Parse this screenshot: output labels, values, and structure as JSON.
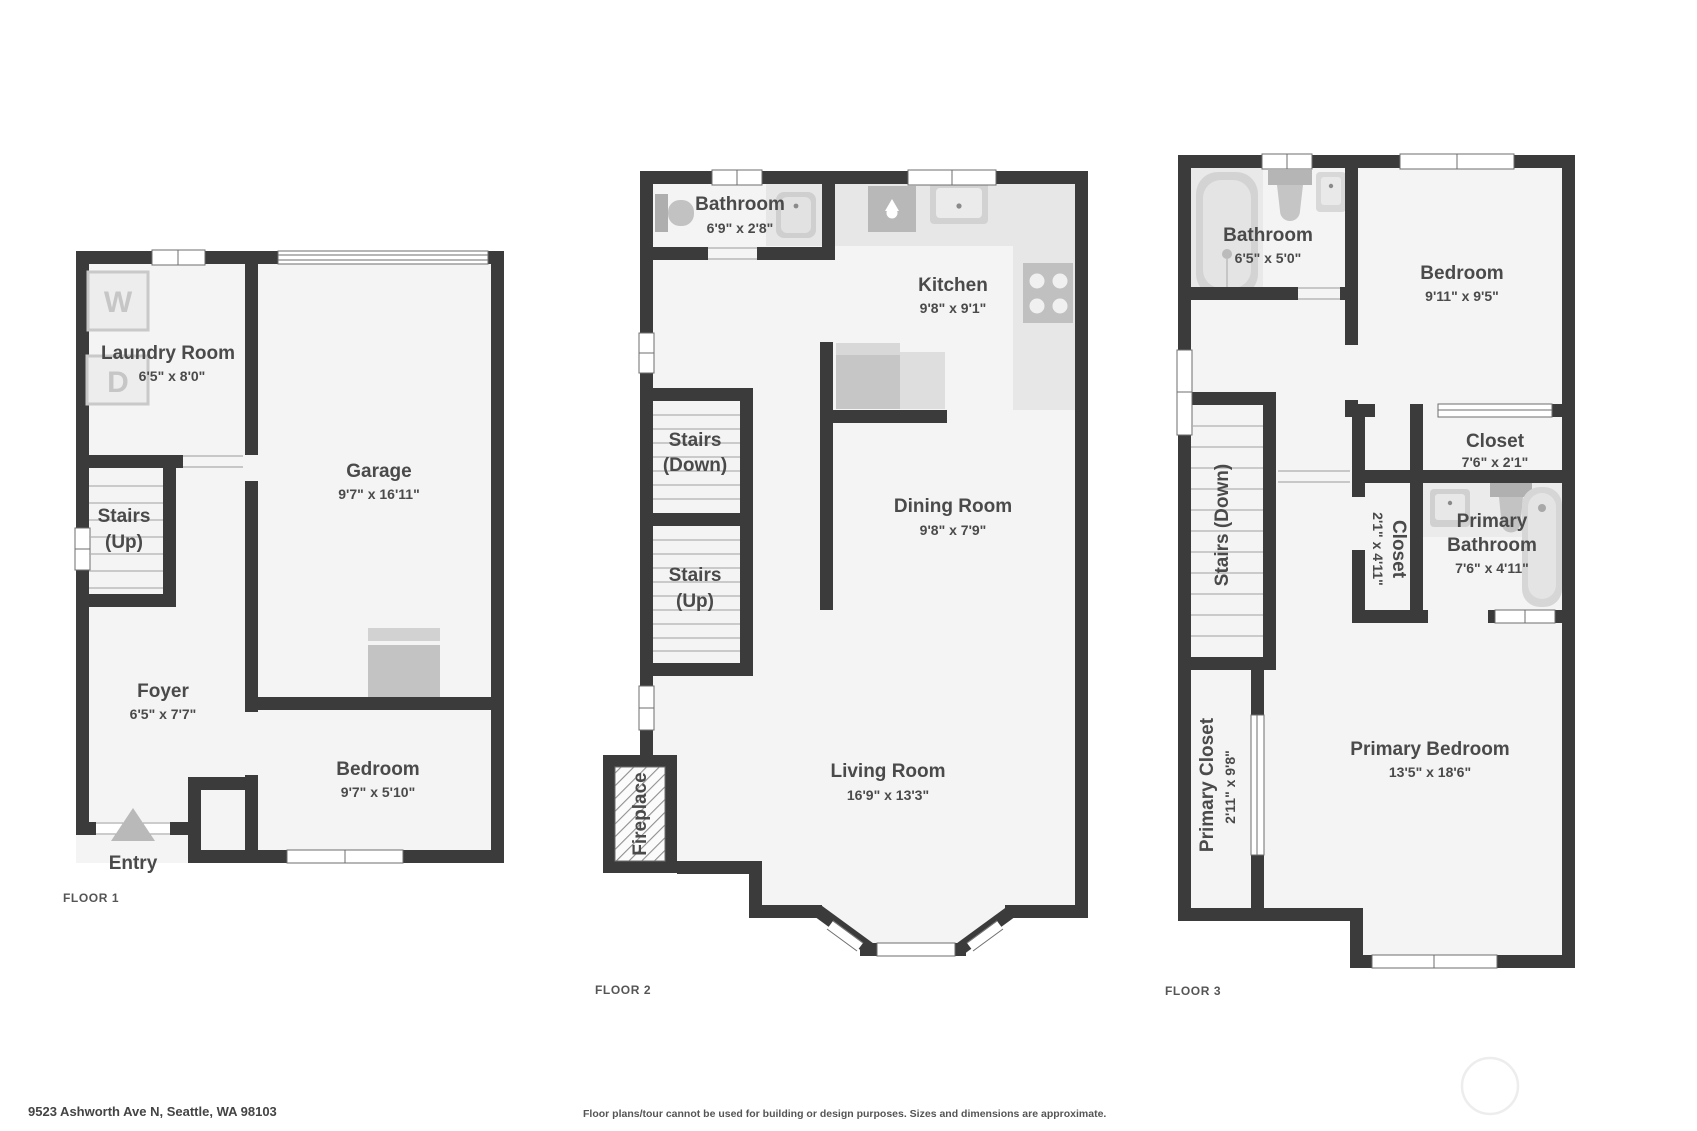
{
  "colors": {
    "wall": "#3b3b3b",
    "floor_fill": "#f4f4f4",
    "fixture": "#c9c9c9",
    "fixture_light": "#e6e6e6",
    "label_text": "#4a4a4a"
  },
  "floor1": {
    "label": "FLOOR 1",
    "laundry_name": "Laundry Room",
    "laundry_dims": "6'5\" x 8'0\"",
    "washer": "W",
    "dryer": "D",
    "stairs_line1": "Stairs",
    "stairs_line2": "(Up)",
    "garage_name": "Garage",
    "garage_dims": "9'7\" x 16'11\"",
    "foyer_name": "Foyer",
    "foyer_dims": "6'5\" x 7'7\"",
    "bedroom_name": "Bedroom",
    "bedroom_dims": "9'7\" x 5'10\"",
    "entry": "Entry"
  },
  "floor2": {
    "label": "FLOOR 2",
    "bathroom_name": "Bathroom",
    "bathroom_dims": "6'9\" x 2'8\"",
    "kitchen_name": "Kitchen",
    "kitchen_dims": "9'8\" x 9'1\"",
    "stairs_down_line1": "Stairs",
    "stairs_down_line2": "(Down)",
    "stairs_up_line1": "Stairs",
    "stairs_up_line2": "(Up)",
    "dining_name": "Dining Room",
    "dining_dims": "9'8\" x 7'9\"",
    "living_name": "Living Room",
    "living_dims": "16'9\" x 13'3\"",
    "fireplace": "Fireplace"
  },
  "floor3": {
    "label": "FLOOR 3",
    "bathroom_name": "Bathroom",
    "bathroom_dims": "6'5\" x 5'0\"",
    "bedroom_name": "Bedroom",
    "bedroom_dims": "9'11\" x 9'5\"",
    "closet_top_name": "Closet",
    "closet_top_dims": "7'6\" x 2'1\"",
    "stairs": "Stairs (Down)",
    "closet_small_name": "Closet",
    "closet_small_dims": "2'1\" x 4'11\"",
    "primary_bath_line1": "Primary",
    "primary_bath_line2": "Bathroom",
    "primary_bath_dims": "7'6\" x 4'11\"",
    "primary_closet_name": "Primary Closet",
    "primary_closet_dims": "2'11\" x 9'8\"",
    "primary_bedroom_name": "Primary Bedroom",
    "primary_bedroom_dims": "13'5\" x 18'6\""
  },
  "footer": {
    "address": "9523 Ashworth Ave N, Seattle, WA 98103",
    "disclaimer": "Floor plans/tour cannot be used for building or design purposes. Sizes and dimensions are approximate."
  }
}
